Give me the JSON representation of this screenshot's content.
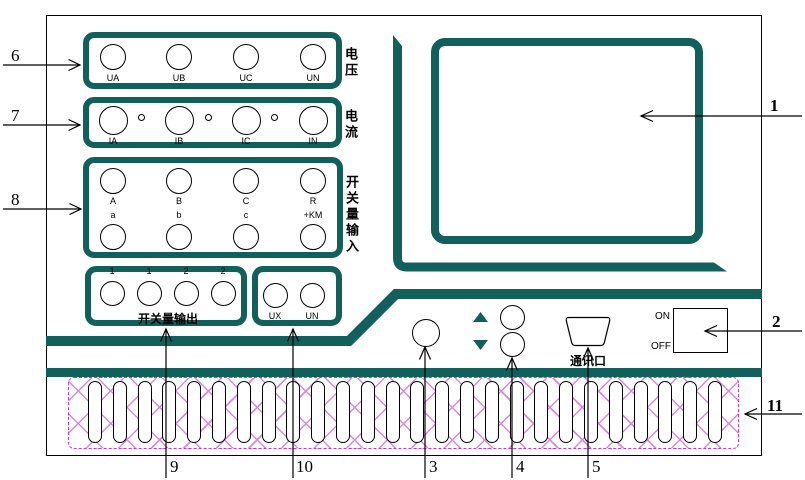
{
  "colors": {
    "teal": "#11605c",
    "magenta": "#cc33cc",
    "hatch": "#dd86dd"
  },
  "groups": {
    "voltage": {
      "label": "电压",
      "terminals": [
        "UA",
        "UB",
        "UC",
        "UN"
      ]
    },
    "current": {
      "label": "电流",
      "terminals": [
        "IA",
        "IB",
        "IC",
        "IN"
      ]
    },
    "switch_input": {
      "label": "开关量输入",
      "row1": [
        "A",
        "B",
        "C",
        "R"
      ],
      "row2": [
        "a",
        "b",
        "c",
        "+KM"
      ]
    },
    "switch_output": {
      "label": "开关量输出",
      "terminals": [
        "1",
        "1",
        "2",
        "2"
      ]
    },
    "aux": {
      "terminals": [
        "UX",
        "UN"
      ]
    }
  },
  "controls": {
    "comm_port_label": "通讯口",
    "power_on": "ON",
    "power_off": "OFF"
  },
  "callouts": {
    "c1": "1",
    "c2": "2",
    "c3": "3",
    "c4": "4",
    "c5": "5",
    "c6": "6",
    "c7": "7",
    "c8": "8",
    "c9": "9",
    "c10": "10",
    "c11": "11"
  },
  "vent": {
    "slot_count": 26
  }
}
